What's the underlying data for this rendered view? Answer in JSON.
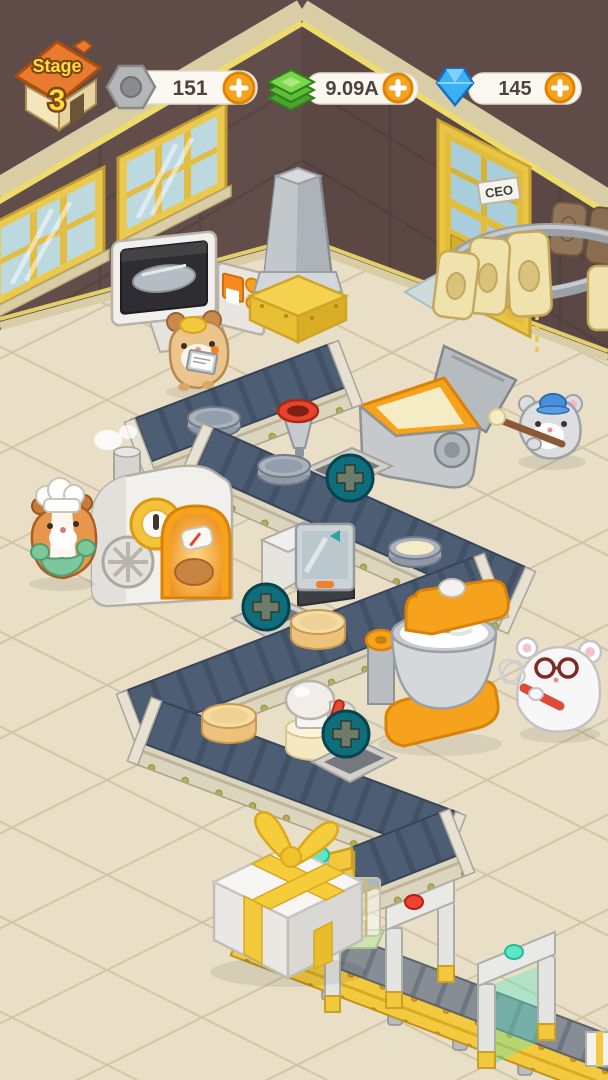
{
  "hud": {
    "stage": {
      "label": "Stage",
      "number": "3"
    },
    "currencies": [
      {
        "name": "bolts",
        "icon": "hex-bolt-icon",
        "value": "151",
        "add_button": "plus-icon"
      },
      {
        "name": "cash",
        "icon": "cash-icon",
        "value": "9.09A",
        "add_button": "plus-icon"
      },
      {
        "name": "gems",
        "icon": "gem-icon",
        "value": "145",
        "add_button": "plus-icon"
      }
    ]
  },
  "room": {
    "door_sign": "CEO"
  },
  "colors": {
    "wall": "#5f4b47",
    "floor": "#e9dfc6",
    "accent_orange": "#f6a21c",
    "belt_top": "#4d5d73",
    "belt_side": "#dcd5bd",
    "upgrade_button_teal": "#0e6e7c",
    "hud_plus_orange": "#f6a21c",
    "mint_light": "#5ce8c8",
    "alert_light": "#ee4130",
    "ribbon_yellow": "#f2c93c",
    "door_yellow": "#e9c445"
  },
  "icons": [
    "stage-house-icon",
    "hex-bolt-icon",
    "cash-icon",
    "gem-icon",
    "plus-icon",
    "upgrade-plus-icon",
    "mint-dome-light",
    "red-dome-light"
  ],
  "scene": {
    "machines": [
      "control-console",
      "exhaust-column",
      "batter-tub",
      "bread-oven",
      "scanner-machine",
      "stand-mixer",
      "frosting-station",
      "wrapping-station",
      "gift-box"
    ],
    "characters": [
      "clipboard-hamster",
      "chef-hamster",
      "stirring-hamster",
      "whisk-hamster"
    ],
    "upgrade_slots": 3
  }
}
